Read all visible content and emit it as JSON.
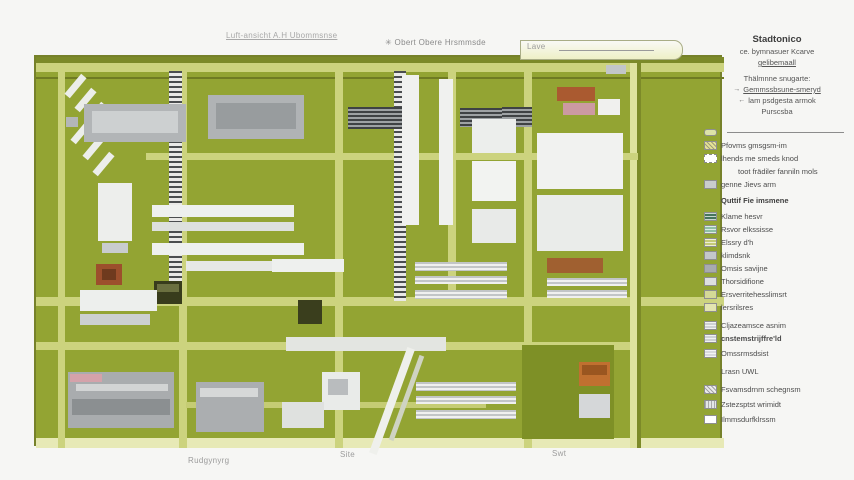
{
  "top_labels": {
    "left": "Luft-ansicht A.H Ubommsnse",
    "mid_icon": "✳",
    "mid": "Obert Obere Hrsmmsde",
    "right": "Lave"
  },
  "bottom_labels": {
    "left": "Rudgynyrg",
    "center": "Site",
    "right": "Swt"
  },
  "legend": {
    "title": "Stadtonico",
    "subtitle1": "ce. bymnasuer Kcarve",
    "subtitle2": "gelibemaall",
    "subtitle3": "Thälmnne snugarte:",
    "nav1_icon": "→",
    "nav1": "Gemmssbsune-smeryd",
    "nav2_icon": "←",
    "nav2": "lam psdgesta armok",
    "subtitle4": "Purscsba",
    "entries": [
      {
        "style": "road-line",
        "color": "#dde3a8",
        "label": ""
      },
      {
        "style": "hatch",
        "color": "#e6e396",
        "label": "Pfovms gmsgsm-im"
      },
      {
        "style": "dash",
        "color": "#ffffff",
        "label": "lhends me smeds knod"
      },
      {
        "style": "none",
        "color": "",
        "label": "toot frädiler fanniln mols",
        "indent": true
      },
      {
        "style": "solid",
        "color": "#c9cccd",
        "label": "genne Jievs arm"
      },
      {
        "style": "none",
        "color": "",
        "label": "Quttif Fie imsmene",
        "sub": true,
        "gap": 3
      },
      {
        "style": "stripes-h",
        "color": "#47755c",
        "label": "Klame hesvr",
        "gap": 3
      },
      {
        "style": "stripes-h",
        "color": "#8fc0a5",
        "label": "Rsvor elkssisse"
      },
      {
        "style": "stripes-h",
        "color": "#c6cb78",
        "label": "Elssry d'h"
      },
      {
        "style": "solid",
        "color": "#c3c7ca",
        "label": "klimdsnk"
      },
      {
        "style": "solid",
        "color": "#a8abae",
        "label": "Omsis savijne"
      },
      {
        "style": "solid",
        "color": "#dddfe1",
        "label": "Thorsidifione"
      },
      {
        "style": "solid",
        "color": "#d5d996",
        "label": "Ersverritehesslimsrt"
      },
      {
        "style": "solid",
        "color": "#e3e5b0",
        "label": "lersrilsres"
      },
      {
        "style": "stripes-h",
        "color": "#cfd2d4",
        "label": "Cljazeamsce asnim",
        "gap": 5
      },
      {
        "style": "stripes-h",
        "color": "#cfd2d4",
        "label": "cnstemstrijffre'ld",
        "bold": true
      },
      {
        "style": "stripes-h",
        "color": "#d8dadc",
        "label": "Omssrmsdsist",
        "gap": 2
      },
      {
        "style": "none",
        "color": "",
        "label": "Lrasn UWL",
        "gap": 5
      },
      {
        "style": "hatch",
        "color": "#ececec",
        "label": "Fsvamsdrnm schegnsm",
        "gap": 5
      },
      {
        "style": "stripes-v",
        "color": "#e4e6e8",
        "label": "Zstezsptst wrimidt",
        "gap": 2
      },
      {
        "style": "solid",
        "color": "#ffffff",
        "label": "Ilmmsdurfklrssm",
        "gap": 2
      }
    ]
  },
  "map": {
    "field_color": "#93a433",
    "shapes": [
      {
        "x": 0,
        "y": 0,
        "w": 688,
        "h": 6,
        "c": "#7c8a29",
        "n": "hedge-top"
      },
      {
        "x": 0,
        "y": 6,
        "w": 688,
        "h": 9,
        "c": "#ccd37e",
        "n": "road-top"
      },
      {
        "x": 0,
        "y": 20,
        "w": 688,
        "h": 2,
        "c": "#6f7b23",
        "n": "hedge-line"
      },
      {
        "x": 0,
        "y": 240,
        "w": 688,
        "h": 9,
        "c": "#ccd37e",
        "n": "road-mid"
      },
      {
        "x": 0,
        "y": 285,
        "w": 602,
        "h": 8,
        "c": "#ccd37e",
        "n": "road-lower"
      },
      {
        "x": 0,
        "y": 381,
        "w": 688,
        "h": 10,
        "c": "#e7e9b6",
        "n": "road-bottom"
      },
      {
        "x": 22,
        "y": 6,
        "w": 7,
        "h": 385,
        "c": "#ccd37e",
        "n": "road-v1"
      },
      {
        "x": 143,
        "y": 6,
        "w": 8,
        "h": 385,
        "c": "#ccd37e",
        "n": "road-v2"
      },
      {
        "x": 299,
        "y": 6,
        "w": 8,
        "h": 385,
        "c": "#ccd37e",
        "n": "road-v3"
      },
      {
        "x": 412,
        "y": 6,
        "w": 8,
        "h": 243,
        "c": "#ccd37e",
        "n": "road-v4"
      },
      {
        "x": 488,
        "y": 6,
        "w": 8,
        "h": 385,
        "c": "#ccd37e",
        "n": "road-v5"
      },
      {
        "x": 594,
        "y": 6,
        "w": 7,
        "h": 385,
        "c": "#dfe3a0",
        "n": "road-v6"
      },
      {
        "x": 601,
        "y": 6,
        "w": 4,
        "h": 385,
        "c": "#7c8a29",
        "n": "hedge-right"
      },
      {
        "x": 110,
        "y": 96,
        "w": 492,
        "h": 7,
        "c": "#ccd37e",
        "n": "road-h2"
      },
      {
        "x": 150,
        "y": 345,
        "w": 300,
        "h": 6,
        "c": "#c5cc74",
        "n": "road-h3"
      },
      {
        "x": 133,
        "y": 14,
        "w": 13,
        "h": 228,
        "cls": "track-v",
        "n": "rail-track"
      },
      {
        "x": 358,
        "y": 14,
        "w": 12,
        "h": 230,
        "cls": "track-v",
        "n": "rail-track"
      },
      {
        "x": 312,
        "y": 50,
        "w": 54,
        "h": 22,
        "cls": "roof-h",
        "n": "striped-roof"
      },
      {
        "x": 424,
        "y": 51,
        "w": 54,
        "h": 19,
        "cls": "roof-h",
        "n": "striped-roof"
      },
      {
        "x": 466,
        "y": 50,
        "w": 30,
        "h": 20,
        "cls": "roof-h",
        "n": "striped-roof"
      },
      {
        "x": 36,
        "y": 16,
        "w": 7,
        "h": 26,
        "c": "#eceeea",
        "r": 40,
        "n": "building"
      },
      {
        "x": 46,
        "y": 30,
        "w": 7,
        "h": 26,
        "c": "#eceeea",
        "r": 40,
        "n": "building"
      },
      {
        "x": 56,
        "y": 44,
        "w": 7,
        "h": 26,
        "c": "#eceeea",
        "r": 40,
        "n": "building"
      },
      {
        "x": 42,
        "y": 62,
        "w": 7,
        "h": 26,
        "c": "#eceeea",
        "r": 40,
        "n": "building"
      },
      {
        "x": 54,
        "y": 78,
        "w": 7,
        "h": 26,
        "c": "#eceeea",
        "r": 40,
        "n": "building"
      },
      {
        "x": 64,
        "y": 94,
        "w": 7,
        "h": 26,
        "c": "#eceeea",
        "r": 40,
        "n": "building"
      },
      {
        "x": 30,
        "y": 60,
        "w": 12,
        "h": 10,
        "c": "#b3b6b8",
        "n": "building"
      },
      {
        "x": 48,
        "y": 47,
        "w": 102,
        "h": 38,
        "c": "#b2b5b7",
        "n": "building"
      },
      {
        "x": 56,
        "y": 54,
        "w": 86,
        "h": 22,
        "c": "#cdd0d1",
        "n": "building-roof"
      },
      {
        "x": 62,
        "y": 126,
        "w": 34,
        "h": 58,
        "c": "#edeeec",
        "n": "building"
      },
      {
        "x": 66,
        "y": 186,
        "w": 26,
        "h": 10,
        "c": "#c9ccce",
        "n": "building"
      },
      {
        "x": 172,
        "y": 38,
        "w": 96,
        "h": 44,
        "c": "#b0b3b5",
        "n": "building"
      },
      {
        "x": 180,
        "y": 46,
        "w": 80,
        "h": 26,
        "c": "#989c9e",
        "n": "building-roof"
      },
      {
        "x": 116,
        "y": 148,
        "w": 142,
        "h": 12,
        "c": "#eef0ee",
        "n": "building"
      },
      {
        "x": 116,
        "y": 165,
        "w": 142,
        "h": 9,
        "c": "#dde0dd",
        "n": "building"
      },
      {
        "x": 116,
        "y": 186,
        "w": 152,
        "h": 12,
        "c": "#eef0ee",
        "n": "building"
      },
      {
        "x": 150,
        "y": 204,
        "w": 132,
        "h": 10,
        "c": "#e6e8e6",
        "n": "building"
      },
      {
        "x": 366,
        "y": 18,
        "w": 17,
        "h": 150,
        "c": "#f0f1ef",
        "n": "building"
      },
      {
        "x": 403,
        "y": 22,
        "w": 14,
        "h": 146,
        "c": "#f0f1ef",
        "n": "building"
      },
      {
        "x": 436,
        "y": 62,
        "w": 44,
        "h": 34,
        "c": "#eceeec",
        "n": "building"
      },
      {
        "x": 436,
        "y": 104,
        "w": 44,
        "h": 40,
        "c": "#f2f3f1",
        "n": "building"
      },
      {
        "x": 436,
        "y": 152,
        "w": 44,
        "h": 34,
        "c": "#e8eae8",
        "n": "building"
      },
      {
        "x": 501,
        "y": 76,
        "w": 86,
        "h": 56,
        "c": "#f1f2f0",
        "n": "building"
      },
      {
        "x": 501,
        "y": 138,
        "w": 86,
        "h": 56,
        "c": "#eaecea",
        "n": "building"
      },
      {
        "x": 521,
        "y": 30,
        "w": 38,
        "h": 14,
        "c": "#aa5a30",
        "n": "red-roof-building"
      },
      {
        "x": 527,
        "y": 46,
        "w": 32,
        "h": 12,
        "c": "#cc9aa2",
        "n": "pink-building"
      },
      {
        "x": 562,
        "y": 42,
        "w": 22,
        "h": 16,
        "c": "#f0f0ee",
        "n": "building"
      },
      {
        "x": 570,
        "y": 8,
        "w": 20,
        "h": 9,
        "c": "#c2c6c8",
        "n": "building"
      },
      {
        "x": 236,
        "y": 202,
        "w": 72,
        "h": 13,
        "c": "#eef0ee",
        "n": "building"
      },
      {
        "x": 250,
        "y": 280,
        "w": 160,
        "h": 14,
        "c": "#e3e5e1",
        "n": "paved-area"
      },
      {
        "x": 379,
        "y": 205,
        "w": 92,
        "h": 9,
        "cls": "rows-h",
        "n": "striped-rows"
      },
      {
        "x": 379,
        "y": 219,
        "w": 92,
        "h": 8,
        "cls": "rows-h",
        "n": "striped-rows"
      },
      {
        "x": 379,
        "y": 233,
        "w": 92,
        "h": 9,
        "cls": "rows-h",
        "n": "striped-rows"
      },
      {
        "x": 511,
        "y": 201,
        "w": 56,
        "h": 15,
        "c": "#a06030",
        "n": "brown-building"
      },
      {
        "x": 511,
        "y": 221,
        "w": 80,
        "h": 8,
        "cls": "rows-h",
        "n": "striped-rows"
      },
      {
        "x": 511,
        "y": 233,
        "w": 80,
        "h": 8,
        "cls": "rows-h",
        "n": "striped-rows"
      },
      {
        "x": 118,
        "y": 224,
        "w": 28,
        "h": 23,
        "c": "#383c1c",
        "n": "dark-building"
      },
      {
        "x": 121,
        "y": 227,
        "w": 22,
        "h": 8,
        "c": "#6b7040",
        "n": "dark-building-roof"
      },
      {
        "x": 262,
        "y": 243,
        "w": 24,
        "h": 24,
        "c": "#3a3e1d",
        "n": "dark-building"
      },
      {
        "x": 60,
        "y": 207,
        "w": 26,
        "h": 21,
        "c": "#9c4f2c",
        "n": "red-roof-building"
      },
      {
        "x": 66,
        "y": 212,
        "w": 14,
        "h": 11,
        "c": "#6f3a1e",
        "n": "red-roof-ridge"
      },
      {
        "x": 44,
        "y": 233,
        "w": 77,
        "h": 21,
        "c": "#edefed",
        "n": "building"
      },
      {
        "x": 44,
        "y": 257,
        "w": 70,
        "h": 11,
        "c": "#ccd0d0",
        "n": "building"
      },
      {
        "x": 32,
        "y": 315,
        "w": 106,
        "h": 56,
        "c": "#a9acae",
        "n": "building-complex"
      },
      {
        "x": 34,
        "y": 317,
        "w": 32,
        "h": 8,
        "c": "#d4a2aa",
        "n": "pink-strip"
      },
      {
        "x": 40,
        "y": 327,
        "w": 92,
        "h": 7,
        "c": "#d2d4d4",
        "n": "building-roof"
      },
      {
        "x": 36,
        "y": 342,
        "w": 98,
        "h": 16,
        "c": "#8b8f91",
        "n": "building"
      },
      {
        "x": 160,
        "y": 325,
        "w": 68,
        "h": 50,
        "c": "#abaeb0",
        "n": "building"
      },
      {
        "x": 164,
        "y": 331,
        "w": 58,
        "h": 9,
        "c": "#d6d8d8",
        "n": "building-roof"
      },
      {
        "x": 286,
        "y": 315,
        "w": 38,
        "h": 38,
        "c": "#e9ebe9",
        "n": "building"
      },
      {
        "x": 292,
        "y": 322,
        "w": 20,
        "h": 16,
        "c": "#b9bcbe",
        "n": "building-roof"
      },
      {
        "x": 246,
        "y": 345,
        "w": 42,
        "h": 26,
        "c": "#dfe1df",
        "n": "building"
      },
      {
        "x": 380,
        "y": 325,
        "w": 100,
        "h": 9,
        "cls": "rows-h",
        "n": "striped-rows"
      },
      {
        "x": 380,
        "y": 339,
        "w": 100,
        "h": 8,
        "cls": "rows-h",
        "n": "striped-rows"
      },
      {
        "x": 380,
        "y": 353,
        "w": 100,
        "h": 9,
        "cls": "rows-h",
        "n": "striped-rows"
      },
      {
        "x": 486,
        "y": 288,
        "w": 92,
        "h": 94,
        "c": "#7e9026",
        "n": "yard"
      },
      {
        "x": 543,
        "y": 305,
        "w": 31,
        "h": 24,
        "c": "#c07030",
        "n": "orange-building"
      },
      {
        "x": 546,
        "y": 308,
        "w": 25,
        "h": 10,
        "c": "#9a5620",
        "n": "orange-building-roof"
      },
      {
        "x": 543,
        "y": 337,
        "w": 31,
        "h": 24,
        "c": "#d5d7d9",
        "n": "building"
      },
      {
        "x": 352,
        "y": 288,
        "w": 8,
        "h": 112,
        "c": "#eff0ec",
        "r": 20,
        "n": "diagonal-path"
      },
      {
        "x": 368,
        "y": 296,
        "w": 5,
        "h": 90,
        "c": "#cfd3c2",
        "r": 20,
        "n": "diagonal-path"
      }
    ]
  }
}
